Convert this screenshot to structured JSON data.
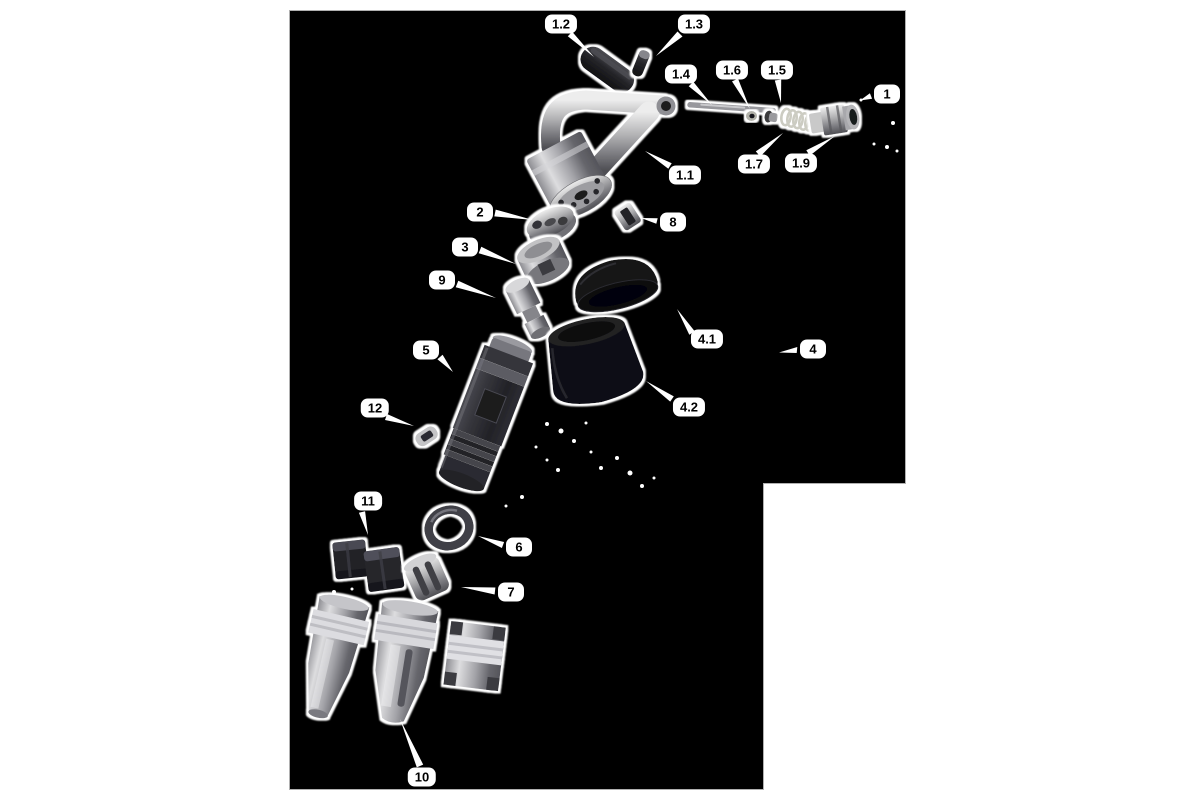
{
  "figure": {
    "kind": "exploded-parts-diagram",
    "colors": {
      "page_background": "#ffffff",
      "canvas_background": "#000000",
      "canvas_border": "#b0b0b0",
      "callout_background": "#ffffff",
      "callout_text": "#000000",
      "leader_line": "#ffffff"
    },
    "callouts": [
      {
        "text": "1.2"
      },
      {
        "text": "1.3"
      },
      {
        "text": "1.4"
      },
      {
        "text": "1.6"
      },
      {
        "text": "1.5"
      },
      {
        "text": "1"
      },
      {
        "text": "1.7"
      },
      {
        "text": "1.9"
      },
      {
        "text": "1.1"
      },
      {
        "text": "2"
      },
      {
        "text": "8"
      },
      {
        "text": "3"
      },
      {
        "text": "9"
      },
      {
        "text": "5"
      },
      {
        "text": "4.1"
      },
      {
        "text": "4"
      },
      {
        "text": "4.2"
      },
      {
        "text": "12"
      },
      {
        "text": "11"
      },
      {
        "text": "6"
      },
      {
        "text": "7"
      },
      {
        "text": "10"
      }
    ]
  }
}
